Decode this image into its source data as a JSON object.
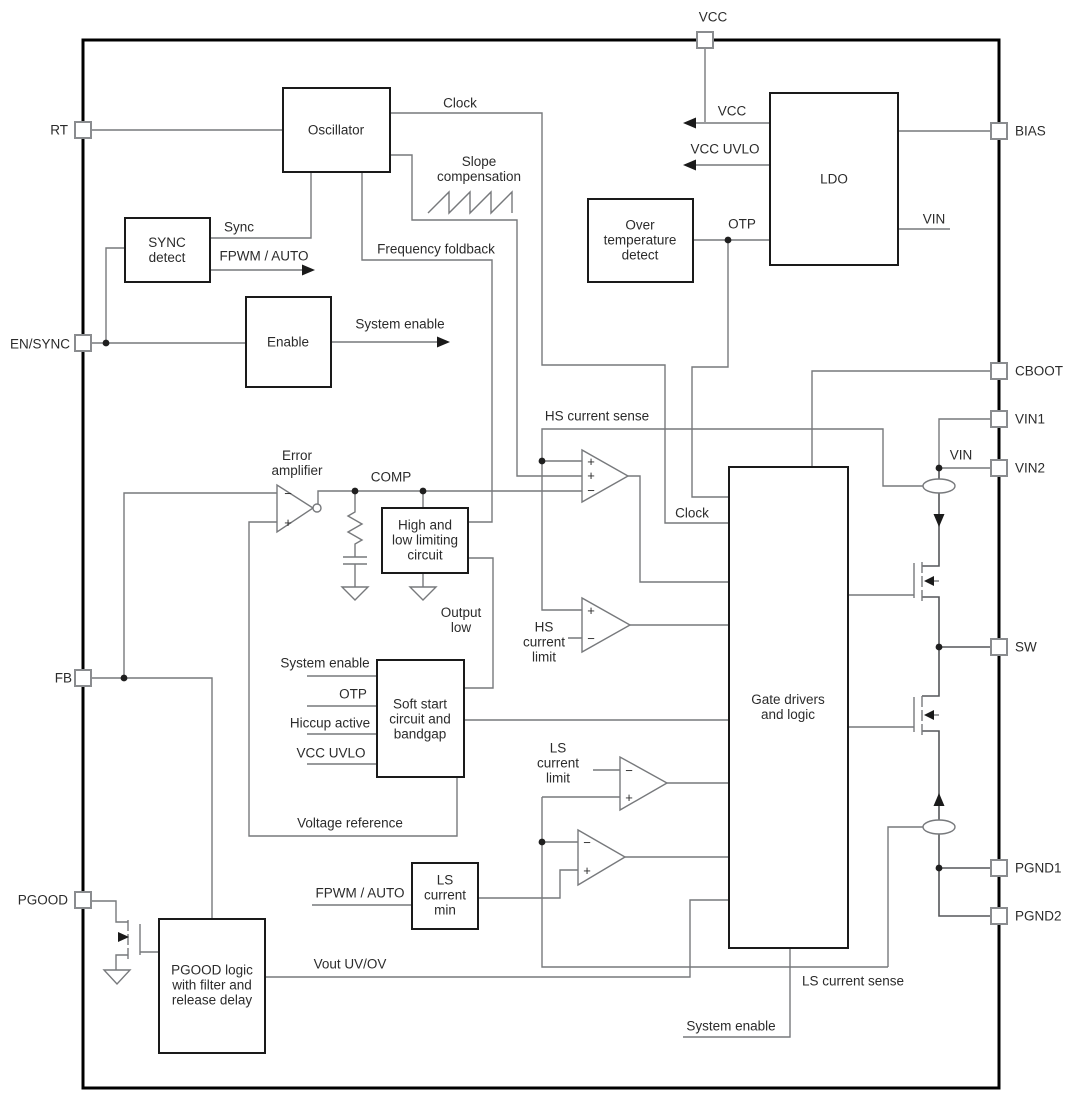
{
  "colors": {
    "background": "#ffffff",
    "wire": "#77797c",
    "block_border": "#1a1a1a",
    "chip_border": "#000000",
    "text": "#2b2b2b"
  },
  "pins": {
    "vcc": "VCC",
    "rt": "RT",
    "en_sync": "EN/SYNC",
    "fb": "FB",
    "pgood": "PGOOD",
    "bias": "BIAS",
    "cboot": "CBOOT",
    "vin1": "VIN1",
    "vin2": "VIN2",
    "sw": "SW",
    "pgnd1": "PGND1",
    "pgnd2": "PGND2"
  },
  "blocks": {
    "oscillator": "Oscillator",
    "sync_detect": "SYNC\ndetect",
    "enable": "Enable",
    "over_temp": "Over\ntemperature\ndetect",
    "ldo": "LDO",
    "error_amp": "Error\namplifier",
    "high_low": "High and\nlow limiting\ncircuit",
    "soft_start": "Soft start\ncircuit and\nbandgap",
    "gate_drivers": "Gate drivers\nand logic",
    "ls_current_min": "LS\ncurrent\nmin",
    "pgood_logic": "PGOOD logic\nwith filter and\nrelease delay"
  },
  "signals": {
    "clock": "Clock",
    "sync": "Sync",
    "fpwm_auto": "FPWM / AUTO",
    "frequency_foldback": "Frequency foldback",
    "slope_compensation": "Slope\ncompensation",
    "system_enable": "System enable",
    "vcc": "VCC",
    "vcc_uvlo": "VCC UVLO",
    "otp": "OTP",
    "vin": "VIN",
    "comp": "COMP",
    "hs_current_sense": "HS current sense",
    "output_low": "Output\nlow",
    "hs_current_limit": "HS\ncurrent\nlimit",
    "hiccup_active": "Hiccup active",
    "voltage_reference": "Voltage reference",
    "ls_current_limit": "LS\ncurrent\nlimit",
    "vout_uv_ov": "Vout UV/OV",
    "ls_current_sense": "LS current sense",
    "plus": "+",
    "minus": "−"
  }
}
